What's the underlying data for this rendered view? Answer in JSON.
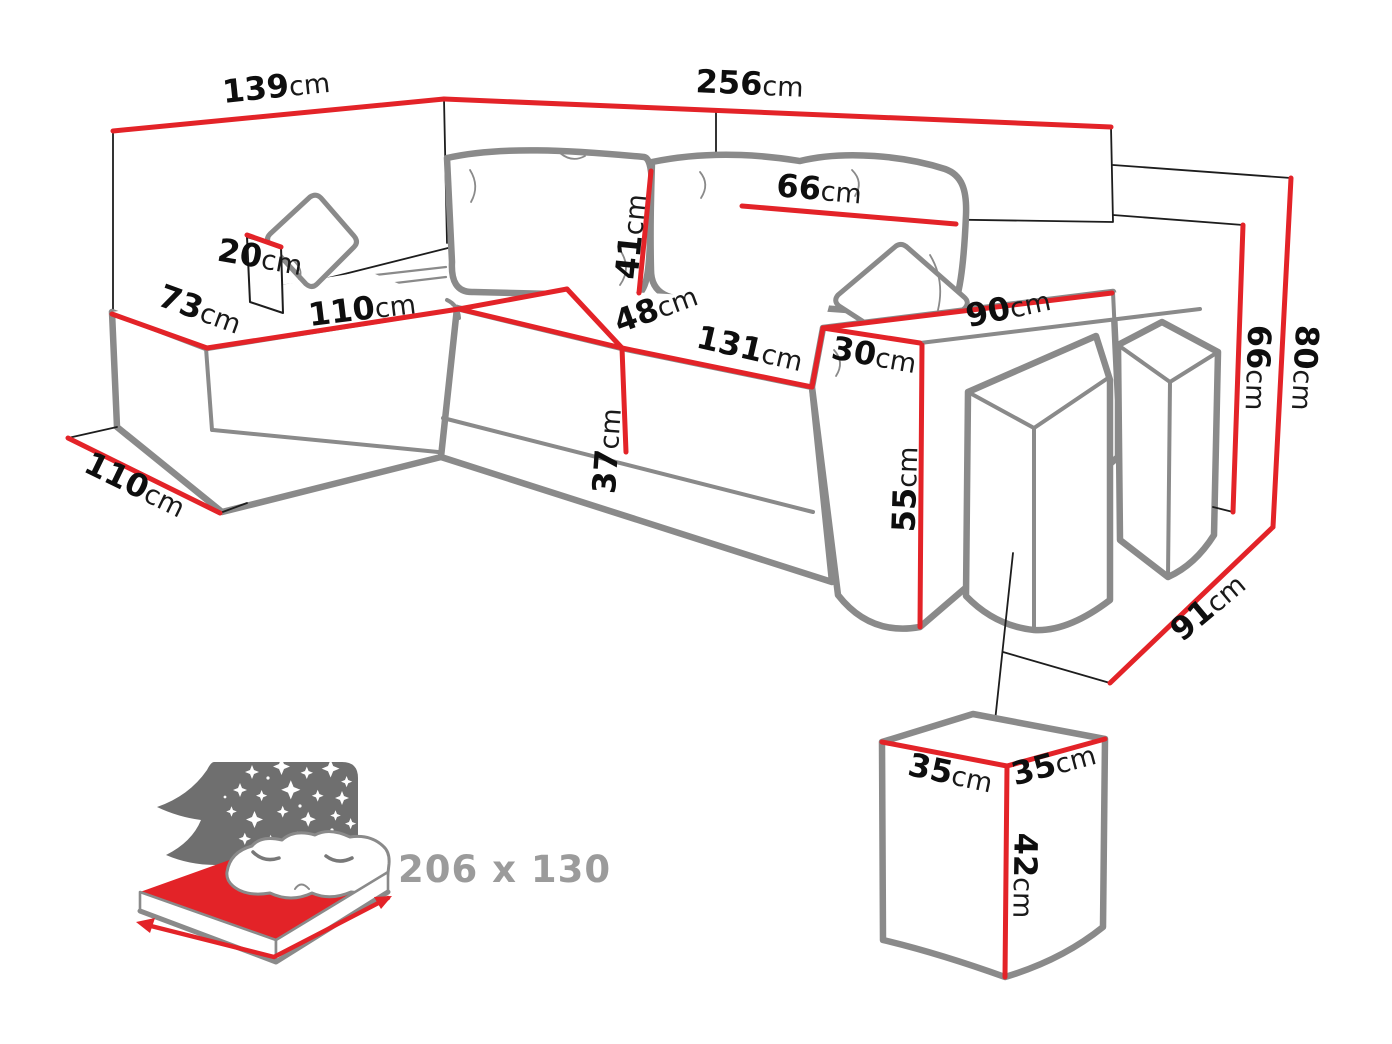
{
  "colors": {
    "red": "#e32328",
    "sofa_gray": "#8a8a8a",
    "ink": "#1d1d1d",
    "muted": "#9b9b9b",
    "backboard": "#6f6f6f"
  },
  "dimensions": {
    "d139": {
      "value": "139",
      "unit": "cm"
    },
    "d256": {
      "value": "256",
      "unit": "cm"
    },
    "d20": {
      "value": "20",
      "unit": "cm"
    },
    "d73": {
      "value": "73",
      "unit": "cm"
    },
    "d110_chaise": {
      "value": "110",
      "unit": "cm"
    },
    "d41": {
      "value": "41",
      "unit": "cm"
    },
    "d66_cushion": {
      "value": "66",
      "unit": "cm"
    },
    "d48": {
      "value": "48",
      "unit": "cm"
    },
    "d131": {
      "value": "131",
      "unit": "cm"
    },
    "d30": {
      "value": "30",
      "unit": "cm"
    },
    "d90": {
      "value": "90",
      "unit": "cm"
    },
    "d37": {
      "value": "37",
      "unit": "cm"
    },
    "d55": {
      "value": "55",
      "unit": "cm"
    },
    "d66_height": {
      "value": "66",
      "unit": "cm"
    },
    "d80_height": {
      "value": "80",
      "unit": "cm"
    },
    "d91": {
      "value": "91",
      "unit": "cm"
    },
    "d110_depth": {
      "value": "110",
      "unit": "cm"
    },
    "d35_left": {
      "value": "35",
      "unit": "cm"
    },
    "d35_right": {
      "value": "35",
      "unit": "cm"
    },
    "d42": {
      "value": "42",
      "unit": "cm"
    }
  },
  "bed": {
    "size_label": "206 x 130"
  }
}
